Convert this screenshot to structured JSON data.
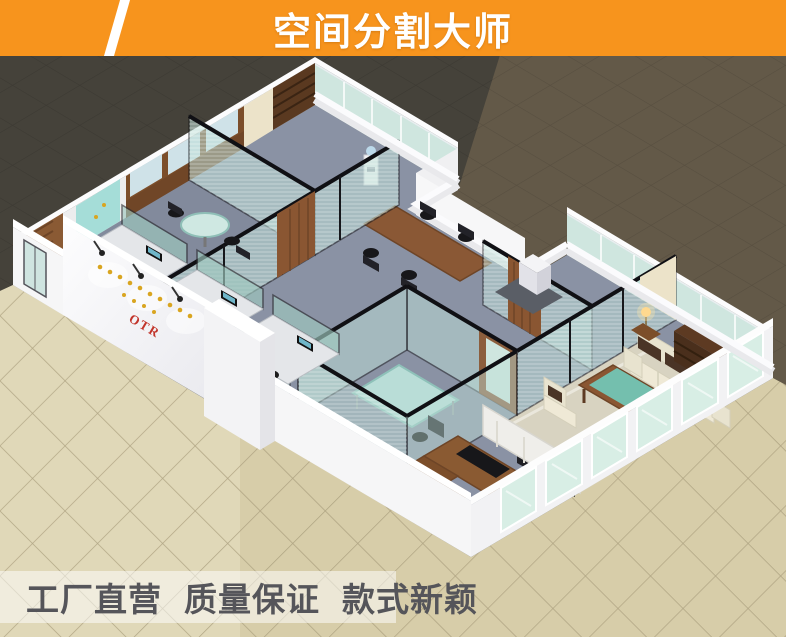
{
  "banner": {
    "title": "空间分割大师",
    "bg_color": "#F7941D",
    "text_color": "#FFFFFF"
  },
  "slogan": {
    "items": [
      "工厂直营",
      "质量保证",
      "款式新颖"
    ],
    "text_color": "#55555A",
    "band_color": "rgba(255,255,255,0.52)"
  },
  "logo_wall": {
    "brand_text": "OTR",
    "brand_color": "#C2352B",
    "accent_color": "#D9A520"
  },
  "colors": {
    "outside_floor_dark": "#45423A",
    "outside_floor_brown": "#635948",
    "outside_floor_tile": "#D7CDA9",
    "carpet_blue_gray": "#8A92A4",
    "partition_glass": "#BFE0D8",
    "partition_frame_black": "#17171B",
    "partition_frame_wood": "#8A5A32",
    "wall_white": "#F6F6F7",
    "sofa_cream": "#E6E1CD",
    "sofa_cushion_brown": "#4C3628",
    "coffee_table_glass": "#74BFAE",
    "marble_counter_black": "#1A211E"
  }
}
